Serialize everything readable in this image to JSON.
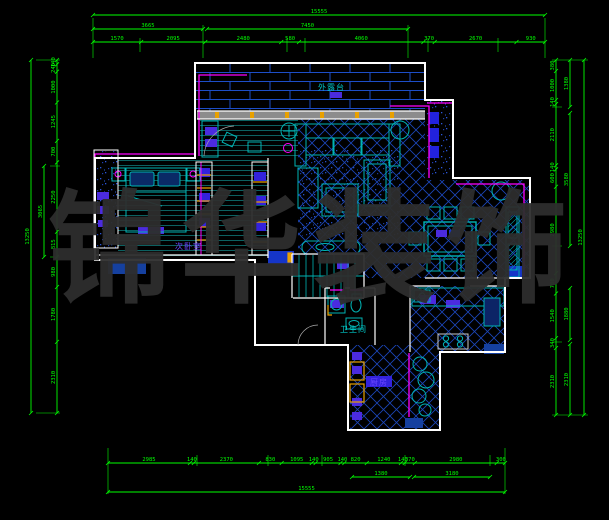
{
  "app": {
    "type": "cad-floorplan-drawing",
    "background": "#000000"
  },
  "watermark": {
    "text": "锦华装饰",
    "chars": [
      "锦",
      "华",
      "装",
      "饰"
    ],
    "color": "#2e2e2e"
  },
  "room_labels": [
    {
      "id": "terrace",
      "text": "外露台",
      "color": "#00c8c8",
      "x": 318,
      "y": 82
    },
    {
      "id": "bedroom2",
      "text": "次卧室",
      "color": "#6a46ff",
      "x": 175,
      "y": 241
    },
    {
      "id": "bathroom",
      "text": "卫生间",
      "color": "#00c8c8",
      "x": 340,
      "y": 324
    },
    {
      "id": "kitchen",
      "text": "厨房",
      "color": "#6a46ff",
      "x": 370,
      "y": 377
    }
  ],
  "dimensions": {
    "top": {
      "total": "15555",
      "tier2": [
        "3665",
        "7450"
      ],
      "segments": [
        "1570",
        "2095",
        "2480",
        "580",
        "4060",
        "370",
        "2670",
        "930"
      ]
    },
    "bottom": {
      "total": "15555",
      "tier2": [
        "1380",
        "3180"
      ],
      "segments": [
        "2985",
        "140",
        "2370",
        "830",
        "1095",
        "140",
        "905",
        "140",
        "820",
        "1240",
        "140",
        "370",
        "2980",
        "300"
      ]
    },
    "left": {
      "total": "13250",
      "tier2": [
        "3065"
      ],
      "segments": [
        "140",
        "240",
        "1000",
        "1245",
        "700",
        "2250",
        "815",
        "980",
        "1780",
        "2310"
      ]
    },
    "right": {
      "total": "13250",
      "tier2": [
        "1380",
        "3580",
        "1880",
        "2310"
      ],
      "segments": [
        "380",
        "1000",
        "140",
        "2110",
        "140",
        "600",
        "2980",
        "700",
        "1540",
        "340",
        "2310"
      ]
    }
  },
  "colors": {
    "dimension_green": "#00ff00",
    "wall_white": "#ffffff",
    "furniture_teal": "#00b4b4",
    "tile_blue": "#1b46bb",
    "accent_magenta": "#ff00ff",
    "fill_blue": "#1535c8",
    "fill_purple": "#4b2bdf",
    "accent_orange": "#e8a000",
    "window_gray": "#8c8c8c"
  }
}
